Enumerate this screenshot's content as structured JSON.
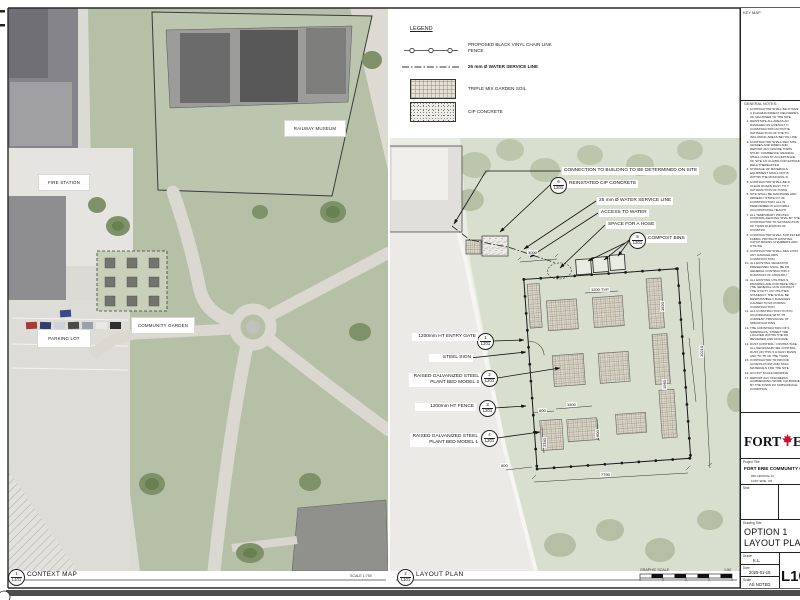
{
  "colors": {
    "leaf_red": "#c8102e",
    "line": "#1a1a1a",
    "grass": "#b5c0a6",
    "pavement": "#dedcd7"
  },
  "views": {
    "context_map": {
      "num": "1",
      "ref": "L101",
      "title": "CONTEXT MAP",
      "scale": "SCALE 1:750"
    },
    "layout_plan": {
      "num": "2",
      "ref": "L101",
      "title": "LAYOUT PLAN",
      "graphic_scale_label": "GRAPHIC SCALE",
      "ratio": "1:50"
    }
  },
  "context_map": {
    "labels": {
      "fire_station": "FIRE STATION",
      "railway_museum": "RAILWAY MUSEUM",
      "community_garden": "COMMUNITY GARDEN",
      "parking_lot": "PARKING LOT"
    }
  },
  "legend": {
    "title": "LEGEND",
    "items": [
      {
        "symbol": "chain-link-fence-line",
        "label": "PROPOSED BLACK VINYL CHAIN LINK FENCE"
      },
      {
        "symbol": "water-service-line",
        "label": "25 mm Ø WATER SERVICE LINE"
      },
      {
        "symbol": "triple-mix-soil-swatch",
        "label": "TRIPLE MIX GARDEN SOIL"
      },
      {
        "symbol": "cip-concrete-swatch",
        "label": "CIP CONCRETE"
      }
    ]
  },
  "callouts": {
    "right": [
      {
        "label": "CONNECTION TO BUILDING TO BE DETERMINED ON SITE"
      },
      {
        "num": "6",
        "ref": "L201",
        "label": "REINSTATED CIP CONCRETE"
      },
      {
        "label": "25 mm Ø WATER SERVICE LINE"
      },
      {
        "label": "ACCESS TO WATER"
      },
      {
        "label": "SPACE FOR A HOSE"
      },
      {
        "num": "5",
        "ref": "L201",
        "label": "COMPOST BINS"
      }
    ],
    "left": [
      {
        "num": "1",
        "ref": "L201",
        "label": "1200mm HT ENTRY GATE"
      },
      {
        "label": "STEEL SIGN"
      },
      {
        "num": "2",
        "ref": "L201",
        "label": "RAISED GALVANIZED STEEL PLANT BED MODEL 2"
      },
      {
        "num": "3",
        "ref": "L201",
        "label": "1200mm HT FENCE"
      },
      {
        "num": "4",
        "ref": "L201",
        "label": "RAISED GALVANIZED STEEL PLANT BED MODEL 1"
      }
    ]
  },
  "dims": {
    "top": "3000",
    "bed_typ": "1200 TYP",
    "right_upper": "1620",
    "right_outer": "10210",
    "right_lower": "1560",
    "bed_len": "1500",
    "gap": "800",
    "bottom_left": "800",
    "bottom_total": "7790",
    "left_lower": "2340",
    "path": "600"
  },
  "title_block": {
    "key_map_label": "KEY MAP",
    "notes_title": "GENERAL NOTES:",
    "notes": [
      "CONTRACTOR SHALL BE R HAVE A FLAGMAN DIRECT DELIVERIES OF MACHINER TO THE SITE",
      "REINSTATE ALL AREAS AN DAMAGED AS A RESULT O CONSTRUCTION ACTIVITIE SATISFACTION OF THE TO INCLUDING AREAS BEYON LINE",
      "CONTRACTOR SHALL REV SITE GRADES AND DIMEN AND REPORT ANY DISCRE TOWN STAFF. COMMENCE GRADING SHALL CONSTIT ACCEPTANCE OF SITE CO CLAIMS FOR EXTRAS RELA THEREAFTER",
      "STORAGE OF MATERIALS EQUIPMENT SHALL NOT B WITHIN THE MUNICIPAL R",
      "CONTRACTOR SHALL BE R CLEAN ROADS DAILY TO T SATISFACTION OF TOWN",
      "SITE SHALL BE MAINTAINE AND ORDERLY STATE FO OF CONSTRUCTION. ALL W PERFORMED IN ACCORDA OCCUPATIONAL HEALTH",
      "ALL TEMPORARY PROTEC CONTROL FENCING SHAL BY THE CONTRACTOR TO SATISFACTION OF TOWN DURATION OF CONSTRU",
      "CONTRACTOR SHALL SUP FILTER FABRIC PROTECTI EXISTING CATCH BASINS CHAMBERS AND UTILITIE",
      "CONTRACTOR SHALL RES COST ANY DAMAGE ARIS CONSTRUCTION",
      "ALL EXISTING VEGETATIO PRESERVED SHALL BE PR GENERAL CONTRACTOR F DURATION OF CONSTRU",
      "ALL EXISTING UTILITIES S DRAWING ARE FOR REFE ONLY. THE GENERAL CON CONTACT THE UTILITY CO UTILITIES STAKEOUT. THE SHALL BE RESPONSIBLE F DAMAGES CAUSED TO EX DURING CONSTRUCTION",
      "ALL CONSTRUCTION TO B IN ACCORDANCE WITH TH CURRENT PROVINCIAL ST SPECIFICATIONS",
      "THE CONSTRUCTION OF S SIDEWALKS, STREET TRE LOCATED WITHIN THE RO REVIEWED AND DOCUME",
      "DUST CONTROL: CONTRA TAKE ALL NECESSARY ME CONTROL DUST ON THIS S A DAILY BASIS AND TO TH OF THE TOWN",
      "CONTRACTOR TO PROVID ACCESS POINT AND STAG MATERIALS FOR THE SITE",
      "DO NOT SCALE DRAWING",
      "REPORT ANY DISCREPAN COMMENCING WORK. NO BORNE BY THE TOWN FO SUBSURFACE CONDITION"
    ],
    "logo_word1": "FORT",
    "logo_word2": "ERIE",
    "project_title_label": "Project Title",
    "project_title": "FORT ERIE COMMUNITY GARDEN",
    "project_address": "### CENTRAL AV",
    "project_city": "FORT ERIE, ON",
    "seal_label": "Seal",
    "drawing_title_label": "Drawing Title",
    "drawing_title_line1": "OPTION 1",
    "drawing_title_line2": "LAYOUT PLAN",
    "fields": [
      {
        "label": "Drawn",
        "value": "K.L."
      },
      {
        "label": "Date",
        "value": "2025-01-15"
      },
      {
        "label": "Scale",
        "value": "AS NOTED"
      }
    ],
    "sheet_number": "L101"
  }
}
